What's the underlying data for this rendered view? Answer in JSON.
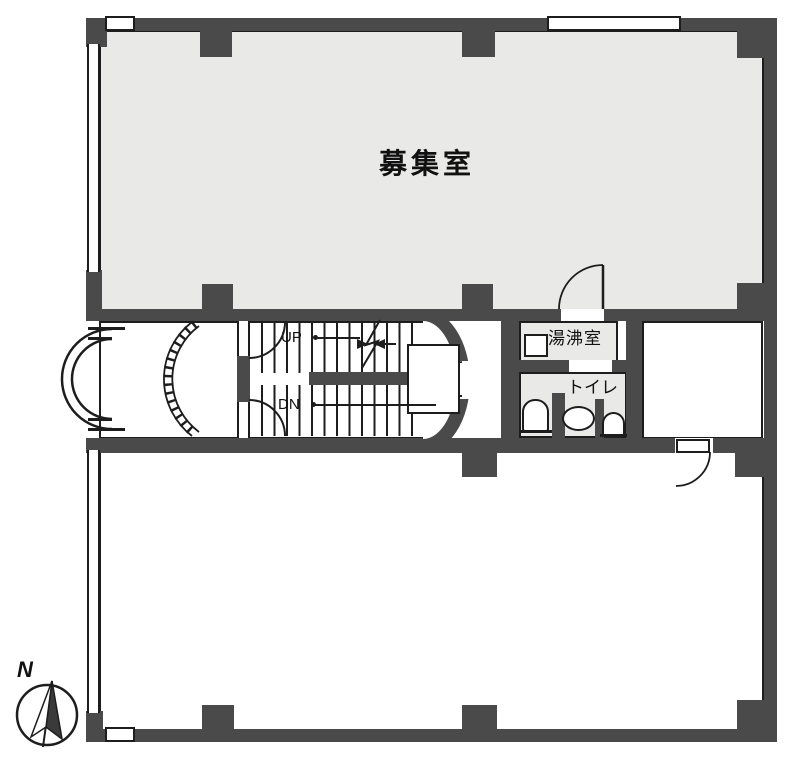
{
  "colors": {
    "wall": "#4a4a4a",
    "room_fill": "#e9e9e7",
    "line": "#1d1d1d",
    "background": "#ffffff"
  },
  "rooms": {
    "main_room": {
      "label": "募集室"
    },
    "kitchenette": {
      "label": "湯沸室"
    },
    "toilet": {
      "label": "トイレ"
    }
  },
  "stairs": {
    "up_label": "UP",
    "down_label": "DN"
  },
  "compass": {
    "north_label": "N"
  }
}
